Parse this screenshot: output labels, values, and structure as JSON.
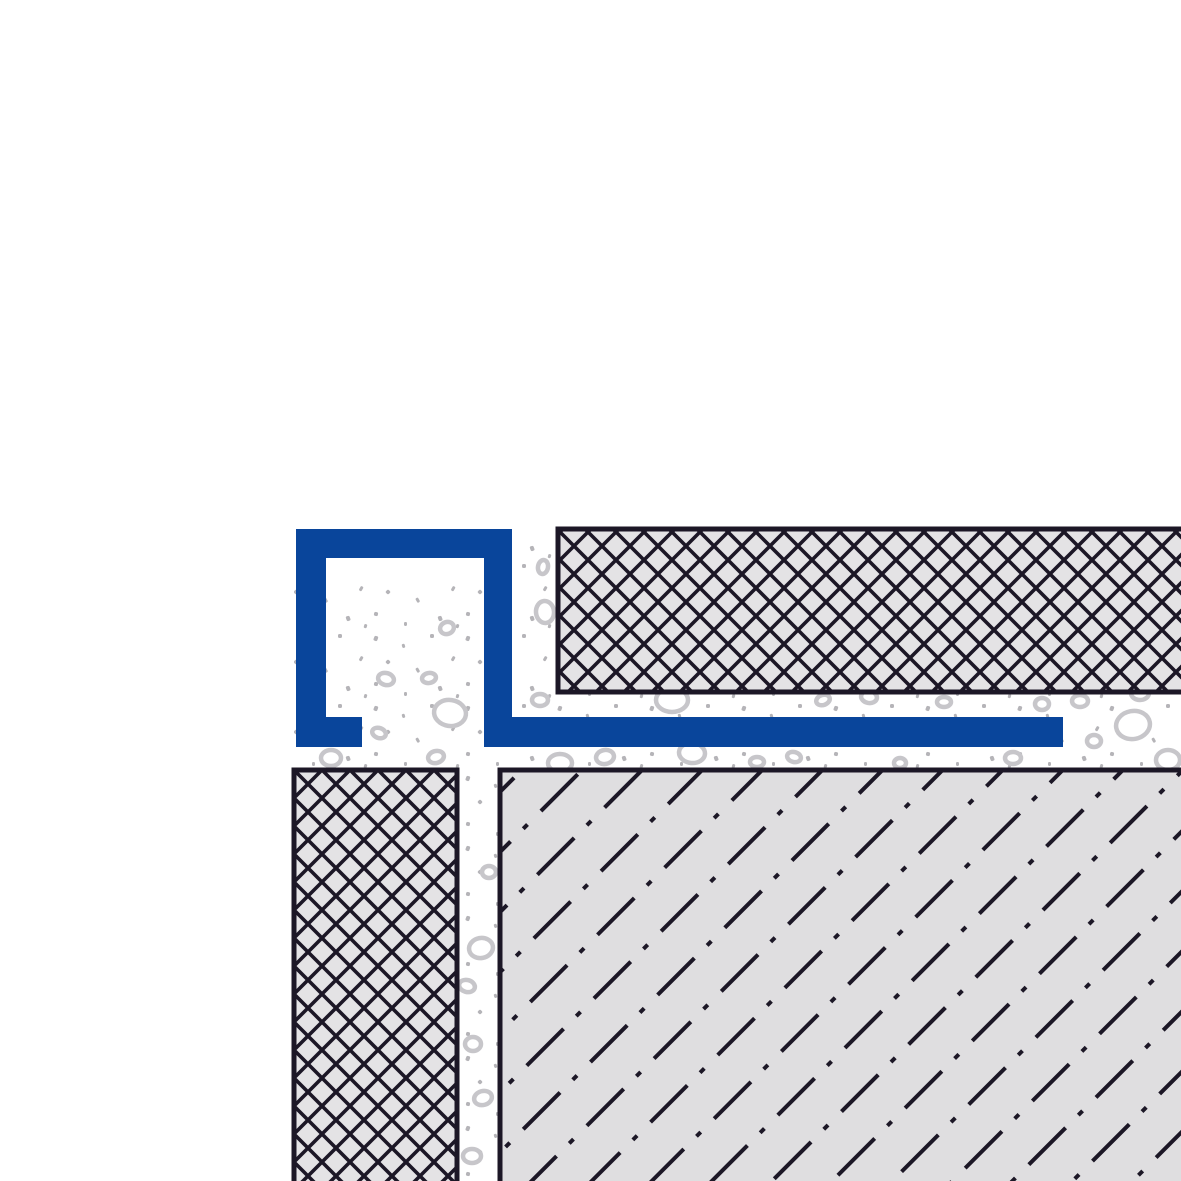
{
  "diagram": {
    "kind": "technical-cross-section",
    "subject": "square-edge tile trim profile installation detail",
    "components": {
      "profile": "square-edge-profile",
      "tile_top": "floor-tile-crosshatched",
      "tile_left": "wall-tile-crosshatched",
      "substrate": "screed-substrate-dash-dot-hatch",
      "mortar": "thin-set-mortar-stippled-with-aggregate"
    }
  },
  "colors": {
    "bg": "#ffffff",
    "profile_blue": "#09459b",
    "hatch": "#1c1726",
    "tile_fill": "#e4e3e5",
    "substrate_fill": "#dfdee0",
    "dot": "#b5b4b8",
    "blob": "#c7c6ca"
  },
  "layout": {
    "canvas": {
      "w": 1181,
      "h": 1181
    },
    "tile_top": {
      "x": 558,
      "y": 529,
      "w": 626,
      "h": 163
    },
    "tile_left": {
      "x": 294,
      "y": 770,
      "w": 163,
      "h": 416
    },
    "substrate": {
      "x": 500,
      "y": 770,
      "w": 686,
      "h": 416
    },
    "mortar_horizontal": {
      "x": 512,
      "y": 528,
      "w": 672,
      "h": 244
    },
    "mortar_vertical": {
      "x": 294,
      "y": 585,
      "w": 218,
      "h": 600
    }
  },
  "profile": {
    "path": "M296 529 L512 529 L512 717 L1063 717 L1063 747 L484 747 L484 558 L326 558 L326 717 L362 717 L362 747 L296 747 Z",
    "wall_thickness": 30,
    "box_outer": {
      "x": 296,
      "y": 529,
      "w": 216,
      "h": 218
    },
    "leg_end_x": 1063
  },
  "patterns": {
    "crosshatch_cell": 28,
    "crosshatch_line_width": 3.6,
    "screed_dash": "52 18 6 19",
    "screed_row_spacing": 42.5,
    "screed_angle_deg": -45
  },
  "mortar": {
    "blobs": [
      [
        447,
        628,
        7,
        6,
        -20
      ],
      [
        386,
        679,
        8,
        6,
        15
      ],
      [
        429,
        678,
        7,
        5,
        -10
      ],
      [
        450,
        713,
        16,
        13,
        8
      ],
      [
        379,
        733,
        7,
        5,
        20
      ],
      [
        331,
        758,
        10,
        8,
        0
      ],
      [
        436,
        757,
        8,
        6,
        -15
      ],
      [
        543,
        567,
        5,
        7,
        10
      ],
      [
        545,
        612,
        9,
        11,
        -5
      ],
      [
        540,
        700,
        8,
        6,
        0
      ],
      [
        672,
        700,
        16,
        12,
        0
      ],
      [
        823,
        700,
        7,
        5,
        -20
      ],
      [
        869,
        697,
        8,
        6,
        10
      ],
      [
        944,
        702,
        7,
        5,
        0
      ],
      [
        1042,
        704,
        7,
        6,
        0
      ],
      [
        1140,
        693,
        9,
        7,
        0
      ],
      [
        1080,
        701,
        8,
        6,
        0
      ],
      [
        1133,
        725,
        17,
        14,
        -10
      ],
      [
        1094,
        741,
        7,
        6,
        0
      ],
      [
        1168,
        760,
        12,
        10,
        0
      ],
      [
        560,
        763,
        12,
        9,
        0
      ],
      [
        605,
        757,
        9,
        7,
        -10
      ],
      [
        692,
        753,
        13,
        10,
        5
      ],
      [
        757,
        762,
        7,
        5,
        0
      ],
      [
        794,
        757,
        7,
        5,
        15
      ],
      [
        900,
        763,
        6,
        5,
        0
      ],
      [
        1013,
        758,
        8,
        6,
        0
      ],
      [
        489,
        872,
        7,
        6,
        0
      ],
      [
        481,
        948,
        12,
        10,
        -10
      ],
      [
        467,
        986,
        8,
        6,
        15
      ],
      [
        473,
        1044,
        8,
        7,
        0
      ],
      [
        483,
        1098,
        9,
        7,
        -15
      ],
      [
        472,
        1156,
        9,
        7,
        0
      ]
    ]
  }
}
